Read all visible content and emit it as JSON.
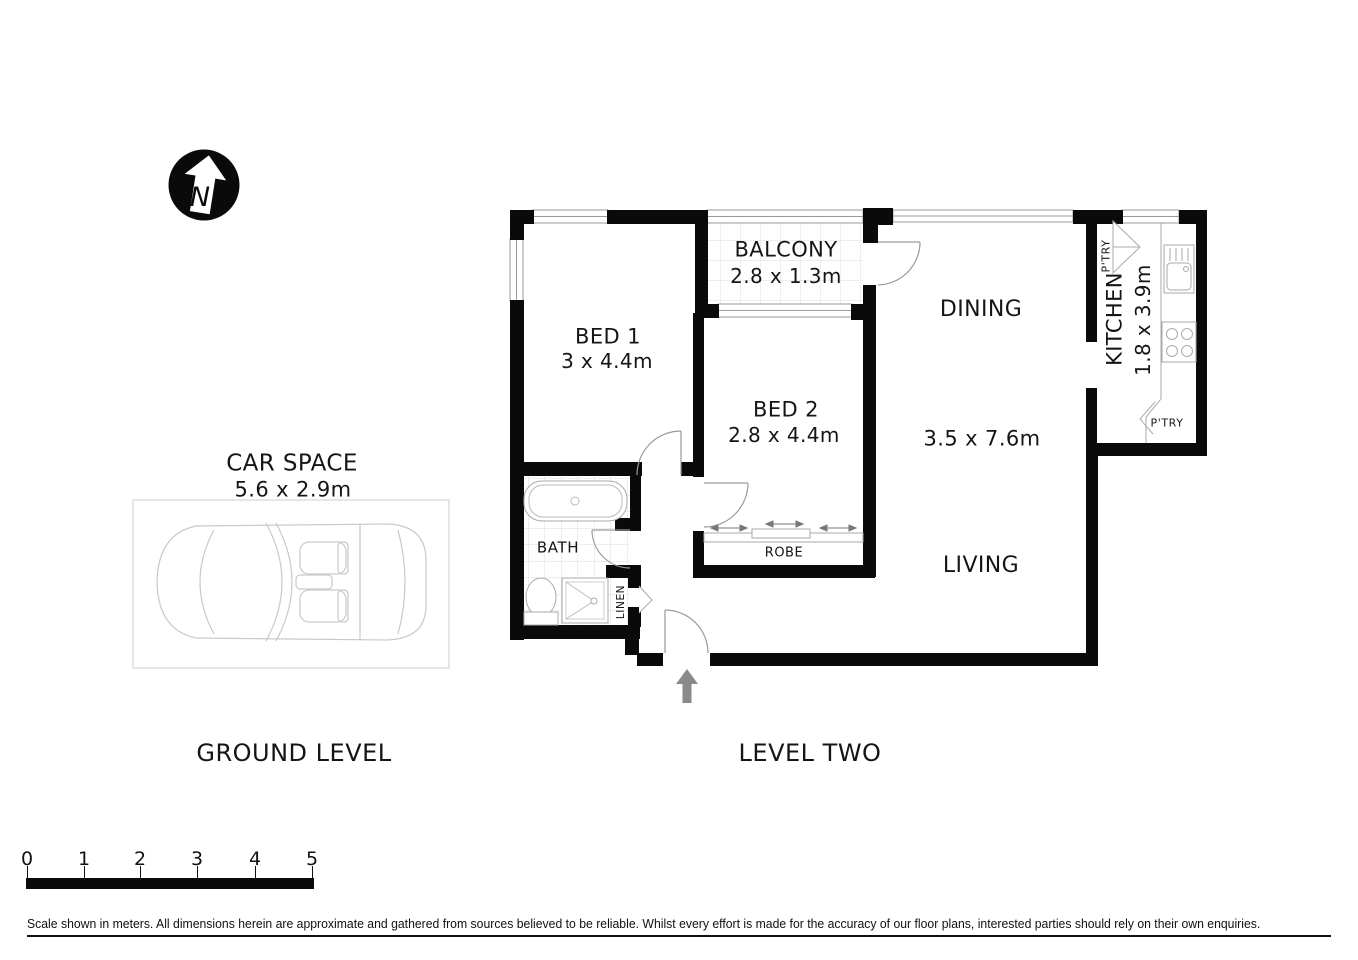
{
  "colors": {
    "wall": "#0a0a0a",
    "thin_line": "#9a9a9a",
    "tile_line": "#d9d9d9",
    "car_line": "#c9c9c9",
    "entry_arrow": "#8a8a8a"
  },
  "north": {
    "letter": "N"
  },
  "ground_level": {
    "label": "GROUND LEVEL",
    "car_space": {
      "name": "CAR SPACE",
      "dims": "5.6 x 2.9m"
    }
  },
  "level_two": {
    "label": "LEVEL TWO",
    "rooms": {
      "bed1": {
        "name": "BED 1",
        "dims": "3 x 4.4m"
      },
      "bed2": {
        "name": "BED 2",
        "dims": "2.8 x 4.4m"
      },
      "balcony": {
        "name": "BALCONY",
        "dims": "2.8 x 1.3m"
      },
      "dining": {
        "name": "DINING"
      },
      "living": {
        "name": "LIVING"
      },
      "living_dining": {
        "dims": "3.5 x 7.6m"
      },
      "kitchen": {
        "name": "KITCHEN",
        "dims": "1.8 x 3.9m"
      },
      "bath": {
        "name": "BATH"
      },
      "robe": {
        "name": "ROBE"
      },
      "linen": {
        "name": "LINEN"
      },
      "pantry_top": {
        "name": "P'TRY"
      },
      "pantry_bottom": {
        "name": "P'TRY"
      }
    }
  },
  "scale_bar": {
    "ticks": [
      "0",
      "1",
      "2",
      "3",
      "4",
      "5"
    ]
  },
  "disclaimer": "Scale shown in meters. All dimensions herein are approximate and gathered from sources believed to be  reliable. Whilst every effort is made for the accuracy of our floor plans, interested parties should rely on their own enquiries."
}
